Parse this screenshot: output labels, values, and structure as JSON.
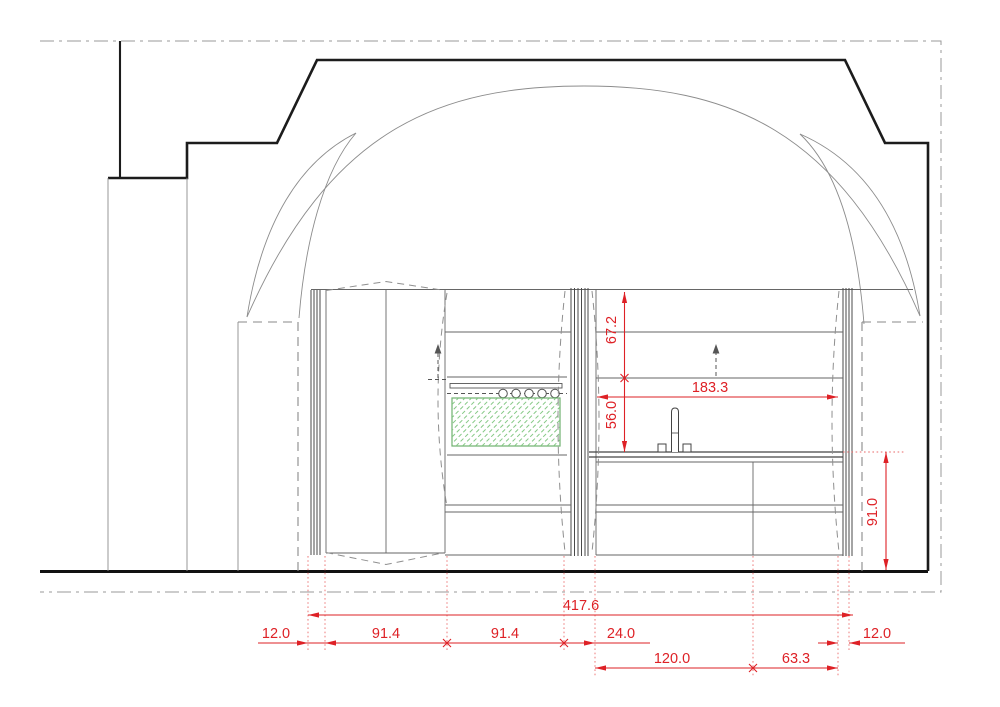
{
  "drawing": {
    "type": "architectural-elevation",
    "subject": "kitchen wall elevation beneath cross-vaulted ceiling",
    "colors": {
      "dimension": "#de2126",
      "hatch": "#86c986",
      "outline": "#1c1c1c"
    },
    "dimensions": {
      "shelf_zone_height": "67.2",
      "backsplash_zone_height": "56.0",
      "worktop_height": "91.0",
      "worktop_clear_width": "183.3",
      "overall_width": "417.6",
      "row1": {
        "left_filler": "12.0",
        "tall_unit": "91.4",
        "oven_unit": "91.4",
        "partition": "24.0",
        "right_filler": "12.0"
      },
      "row2": {
        "sink_bay": "120.0",
        "right_bay": "63.3"
      }
    }
  }
}
